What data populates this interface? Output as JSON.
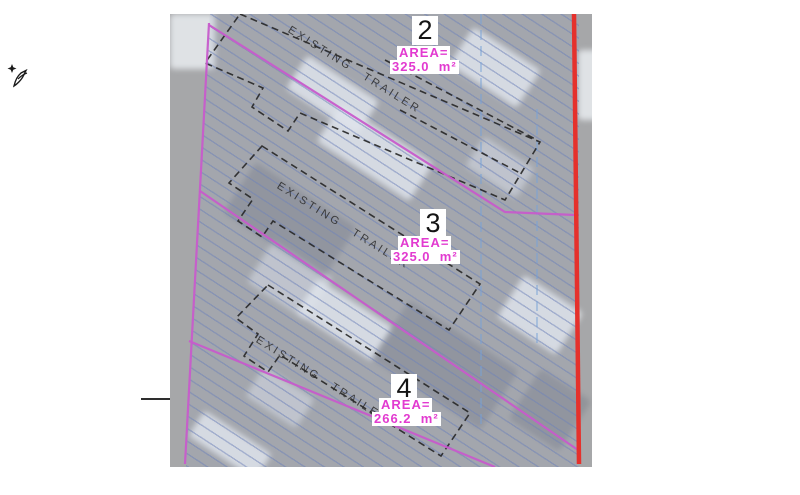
{
  "colors": {
    "photo_gray": "#a6a7a9",
    "hatch_blue": "#6e82b9",
    "boundary_magenta": "#c75bcb",
    "edge_red": "#e5312c",
    "centerline_blue": "#78a2d8",
    "trailer_outline": "#262626",
    "lot_number_color": "#141414",
    "area_text_magenta": "#e23ad0",
    "label_bg": "#ffffff"
  },
  "plan": {
    "lots": [
      {
        "number": "2",
        "area_label": "AREA=",
        "area_value": "325.0  m²",
        "trailer_label": "EXISTING TRAILER"
      },
      {
        "number": "3",
        "area_label": "AREA=",
        "area_value": "325.0  m²",
        "trailer_label": "EXISTING TRAILER"
      },
      {
        "number": "4",
        "area_label": "AREA=",
        "area_value": "266.2  m²",
        "trailer_label": "EXISTING TRAILER"
      }
    ]
  }
}
